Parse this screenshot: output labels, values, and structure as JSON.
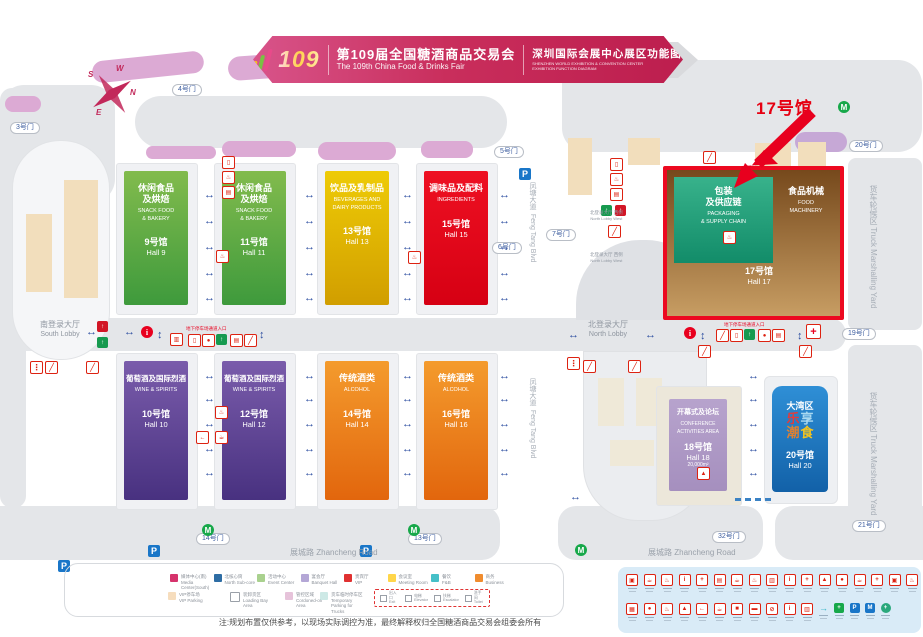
{
  "header": {
    "logo_number": "109",
    "title_cn": "第109届全国糖酒商品交易会",
    "title_en": "The 109th China Food & Drinks Fair",
    "subtitle_cn": "深圳国际会展中心展区功能图",
    "subtitle_en1": "SHENZHEN WORLD EXHIBITION & CONVENTION CENTER",
    "subtitle_en2": "EXHIBITION FUNCTION DIAGRAM"
  },
  "annotation": {
    "hall17_label": "17号馆"
  },
  "compass": {
    "n": "N",
    "s": "S",
    "e": "E",
    "w": "W"
  },
  "halls": [
    {
      "id": "9",
      "cn": [
        "休闲食品",
        "及烘焙"
      ],
      "en": [
        "SNACK FOOD",
        "& BAKERY"
      ],
      "num": "9号馆",
      "name": "Hall 9",
      "c1": "#82bb4d",
      "c2": "#3e9a3c"
    },
    {
      "id": "11",
      "cn": [
        "休闲食品",
        "及烘焙"
      ],
      "en": [
        "SNACK FOOD",
        "& BAKERY"
      ],
      "num": "11号馆",
      "name": "Hall 11",
      "c1": "#82bb4d",
      "c2": "#3e9a3c"
    },
    {
      "id": "13",
      "cn": [
        "饮品及乳制品"
      ],
      "en": [
        "BEVERAGES AND",
        "DAIRY PRODUCTS"
      ],
      "num": "13号馆",
      "name": "Hall 13",
      "c1": "#eecb06",
      "c2": "#d19e00"
    },
    {
      "id": "15",
      "cn": [
        "调味品及配料"
      ],
      "en": [
        "INGREDIENTS"
      ],
      "num": "15号馆",
      "name": "Hall 15",
      "c1": "#ee1022",
      "c2": "#d60013"
    },
    {
      "id": "10",
      "cn": [
        "葡萄酒及国际烈酒"
      ],
      "en": [
        "WINE & SPIRITS"
      ],
      "num": "10号馆",
      "name": "Hall 10",
      "c1": "#7a5cab",
      "c2": "#483180"
    },
    {
      "id": "12",
      "cn": [
        "葡萄酒及国际烈酒"
      ],
      "en": [
        "WINE & SPIRITS"
      ],
      "num": "12号馆",
      "name": "Hall 12",
      "c1": "#7a5cab",
      "c2": "#483180"
    },
    {
      "id": "14",
      "cn": [
        "传统酒类"
      ],
      "en": [
        "ALCOHOL"
      ],
      "num": "14号馆",
      "name": "Hall 14",
      "c1": "#f49b2d",
      "c2": "#e2660d"
    },
    {
      "id": "16",
      "cn": [
        "传统酒类"
      ],
      "en": [
        "ALCOHOL"
      ],
      "num": "16号馆",
      "name": "Hall 16",
      "c1": "#f49b2d",
      "c2": "#e2660d"
    },
    {
      "id": "18",
      "cn": [
        "开幕式及论坛"
      ],
      "en": [
        "CONFERENCE",
        "ACTIVITIES AREA"
      ],
      "num": "18号馆",
      "name": "Hall 18",
      "area": "20,000m²",
      "c1": "#b7a3cd",
      "c2": "#a58fbe"
    }
  ],
  "hall17": {
    "left_cn": [
      "包装",
      "及供应链"
    ],
    "left_en": [
      "PACKAGING",
      "& SUPPLY CHAIN"
    ],
    "right_cn": "食品机械",
    "right_en": [
      "FOOD",
      "MACHINERY"
    ],
    "num": "17号馆",
    "name": "Hall 17",
    "highlight": "#ec0920"
  },
  "hall20": {
    "region": "大湾区",
    "chars": [
      {
        "t": "乐",
        "c": "#e23c3c"
      },
      {
        "t": "享",
        "c": "#a8d8f0"
      },
      {
        "t": "潮",
        "c": "#e08030"
      },
      {
        "t": "食",
        "c": "#f3c320"
      }
    ],
    "num": "20号馆",
    "name": "Hall 20"
  },
  "gates": [
    "3号门",
    "4号门",
    "5号门",
    "6号门",
    "7号门",
    "20号门",
    "19号门",
    "14号门",
    "13号门",
    "32号门",
    "21号门"
  ],
  "roads": {
    "zhancheng_cn": "展城路",
    "zhancheng_en": "Zhancheng Road",
    "fengtang_cn": "凤塘大道",
    "fengtang_en": "Feng Tang Blvd",
    "truck_cn": "货车轮候区",
    "truck_en": "Truck Marshalling Yard"
  },
  "lobbies": {
    "south_cn": "南登录大厅",
    "south_en": "South Lobby",
    "north_cn": "北登录大厅",
    "north_en": "North Lobby",
    "nw_cn": "北登录大厅 西侧",
    "nw_en": "North Lobby West"
  },
  "labels": {
    "underground_entrance": "地下停车场通道入口"
  },
  "legend": {
    "row1": [
      {
        "c": "#d6336c",
        "cn": "媒体中心(南)",
        "en": "Media Center(South)"
      },
      {
        "c": "#2e6da4",
        "cn": "北核心筒",
        "en": "North Sub-core"
      },
      {
        "c": "#a9d18e",
        "cn": "活动中心",
        "en": "Event Center"
      },
      {
        "c": "#b4a7d6",
        "cn": "宴会厅",
        "en": "Banquet Hall"
      },
      {
        "c": "#e03131",
        "cn": "贵宾厅",
        "en": "VIP"
      },
      {
        "c": "#ffd64a",
        "cn": "会议室",
        "en": "Meeting Room"
      },
      {
        "c": "#45c0c8",
        "cn": "餐饮",
        "en": "F&B"
      },
      {
        "c": "#f08c2e",
        "cn": "商务",
        "en": "Business"
      }
    ],
    "row2": [
      {
        "c": "#f6ddbd",
        "cn": "VIP停车场",
        "en": "VIP Parking"
      },
      {
        "c": "#ffffff",
        "cn": "装卸货区",
        "en": "Loading Bay Area",
        "border": true
      },
      {
        "c": "#e6c3da",
        "cn": "管控区域",
        "en": "Cordoned-off Area"
      },
      {
        "c": "#cde9e6",
        "cn": "货车临时停车区",
        "en": "Temporary Parking for Trucks"
      }
    ],
    "dashed_items": [
      {
        "cn": "出入口",
        "en": "Exit"
      },
      {
        "cn": "电梯",
        "en": "Elevator"
      },
      {
        "cn": "扶梯",
        "en": "Escalator"
      },
      {
        "cn": "洗手间",
        "en": "Toilet"
      }
    ]
  },
  "note": "注:规划布置仅供参考，以现场实际调控为准，最终解释权归全国糖酒商品交易会组委会所有",
  "facility_panel": {
    "row1": [
      "▣",
      "☕",
      "♨",
      "i",
      "+",
      "▤",
      "☕",
      "♨",
      "▥",
      "i",
      "+",
      "▲",
      "●",
      "☕",
      "+",
      "▣",
      "♨",
      "i"
    ],
    "row2": [
      {
        "g": "▦"
      },
      {
        "g": "●"
      },
      {
        "g": "♨"
      },
      {
        "g": "▲"
      },
      {
        "g": "←"
      },
      {
        "g": "☕"
      },
      {
        "g": "■"
      },
      {
        "g": "▬"
      },
      {
        "g": "⊘"
      },
      {
        "g": "i"
      },
      {
        "g": "▥"
      },
      {
        "g": "→",
        "c": "t"
      },
      {
        "g": "+",
        "c": "g"
      },
      {
        "g": "P",
        "c": "b"
      },
      {
        "g": "M",
        "c": "b"
      },
      {
        "g": "+",
        "c": "m"
      }
    ]
  }
}
